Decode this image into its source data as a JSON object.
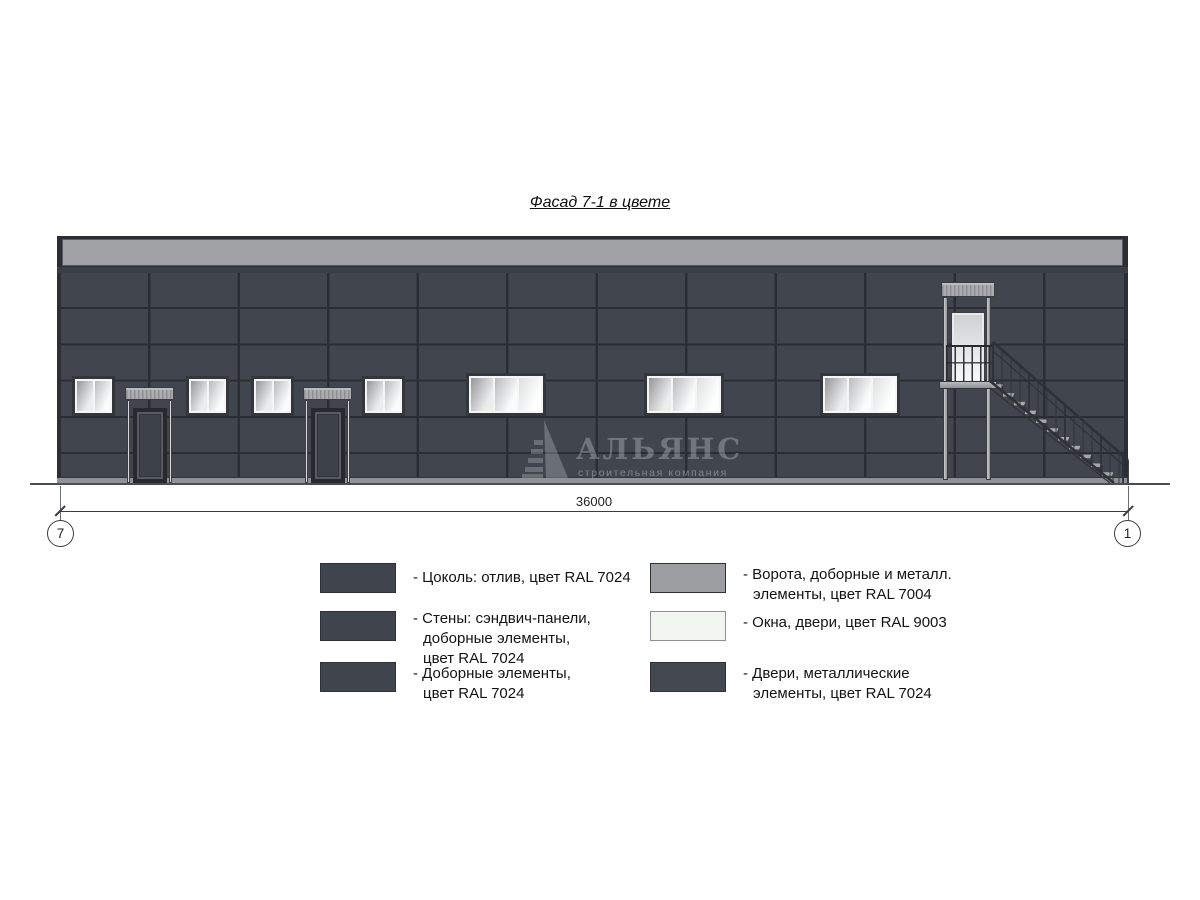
{
  "title": "Фасад 7-1 в цвете",
  "watermark": {
    "name": "АЛЬЯНС",
    "subtitle": "строительная компания"
  },
  "dimension": {
    "value": "36000",
    "axis_left": "7",
    "axis_right": "1"
  },
  "colors": {
    "ral_7024_walls": "#41464e",
    "ral_7004_metal": "#9c9ea1",
    "ral_9003_windows": "#f2f6f1",
    "cornice_gray": "#a0a2a5",
    "outline_dark": "#2b2f35"
  },
  "legend": {
    "left": [
      {
        "label": "- Цоколь: отлив, цвет RAL 7024",
        "color": "#40454d"
      },
      {
        "label": "- Стены: сэндвич-панели,\nдоборные элементы,\nцвет RAL 7024",
        "color": "#40454d"
      },
      {
        "label": "- Доборные элементы,\nцвет RAL 7024",
        "color": "#40454d"
      }
    ],
    "right": [
      {
        "label": "- Ворота, доборные и металл.\nэлементы, цвет RAL 7004",
        "color": "#9c9ea1"
      },
      {
        "label": "- Окна, двери, цвет RAL 9003",
        "color": "#f2f6f1",
        "border": "#8d9093"
      },
      {
        "label": "- Двери, металлические\nэлементы, цвет RAL 7024",
        "color": "#444951"
      }
    ]
  }
}
